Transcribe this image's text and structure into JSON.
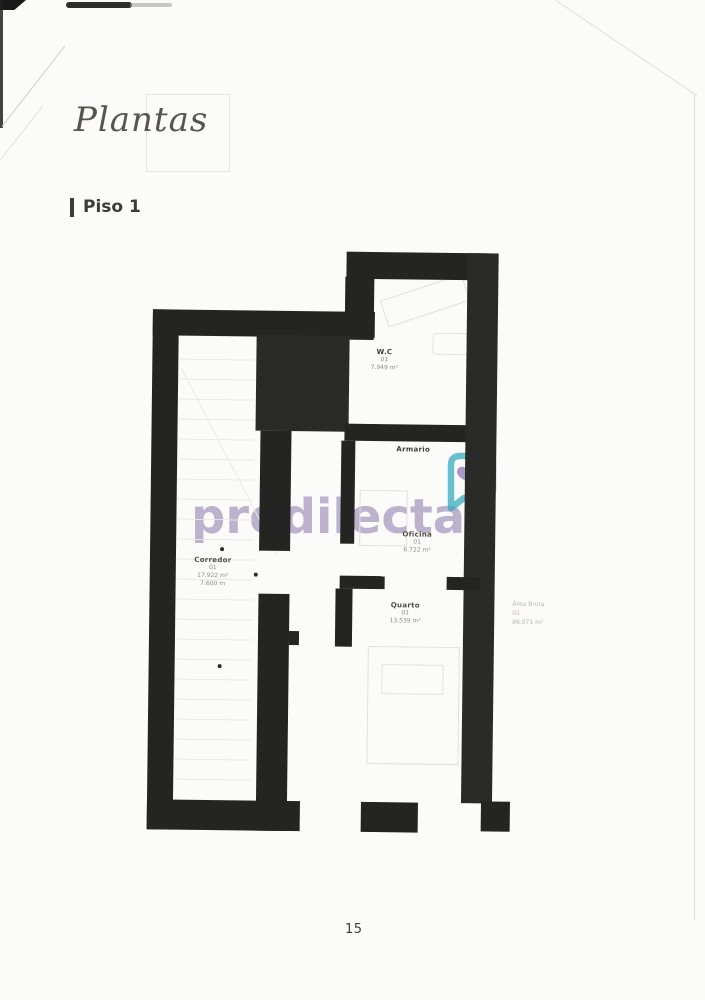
{
  "page": {
    "title": "Plantas",
    "section_label": "Piso 1",
    "page_number": "15"
  },
  "watermark": {
    "brand": "predilecta",
    "text_color": "#b3a6c6",
    "logo": "house-bubble-heart-icon",
    "logo_outline_color": "#2fa7bd",
    "logo_heart_color": "#8d7ab5"
  },
  "floorplan": {
    "wall_color": "#242422",
    "rooms": [
      {
        "name": "W.C",
        "number": "01",
        "area": "7.949 m²"
      },
      {
        "name": "Armario",
        "number": "",
        "area": ""
      },
      {
        "name": "Oficina",
        "number": "01",
        "area": "6.722 m²"
      },
      {
        "name": "Quarto",
        "number": "01",
        "area": "13.539 m²"
      },
      {
        "name": "Corredor",
        "number": "01",
        "area": "17.922 m²",
        "extra": "7.600 m"
      }
    ],
    "annotation": {
      "label": "Área Bruta",
      "number": "01",
      "area": "86.071 m²"
    }
  }
}
